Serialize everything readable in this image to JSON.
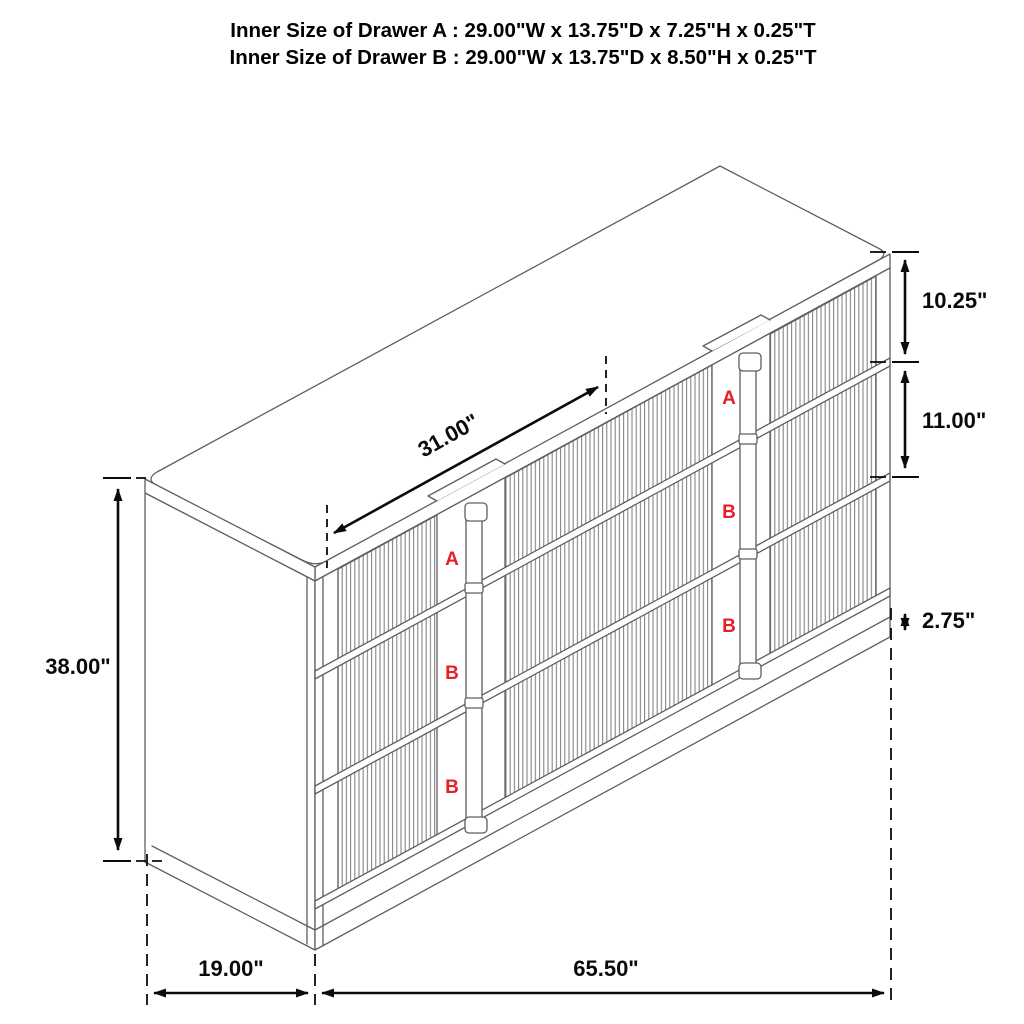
{
  "title": {
    "line1": "Inner Size of Drawer A : 29.00\"W x 13.75\"D x 7.25\"H x 0.25\"T",
    "line2": "Inner Size of Drawer B : 29.00\"W x 13.75\"D x 8.50\"H x 0.25\"T"
  },
  "dimensions": {
    "top_diagonal_width": "31.00\"",
    "top_drawer_height": "10.25\"",
    "middle_drawer_height": "11.00\"",
    "base_height": "2.75\"",
    "overall_height": "38.00\"",
    "overall_depth": "19.00\"",
    "overall_width": "65.50\""
  },
  "drawer_labels": {
    "left": [
      "A",
      "B",
      "B"
    ],
    "right": [
      "A",
      "B",
      "B"
    ]
  },
  "colors": {
    "label_red": "#e62026",
    "drawing_gray": "#5f5f5f",
    "dimension_black": "#0b0b0b",
    "background": "#ffffff"
  }
}
